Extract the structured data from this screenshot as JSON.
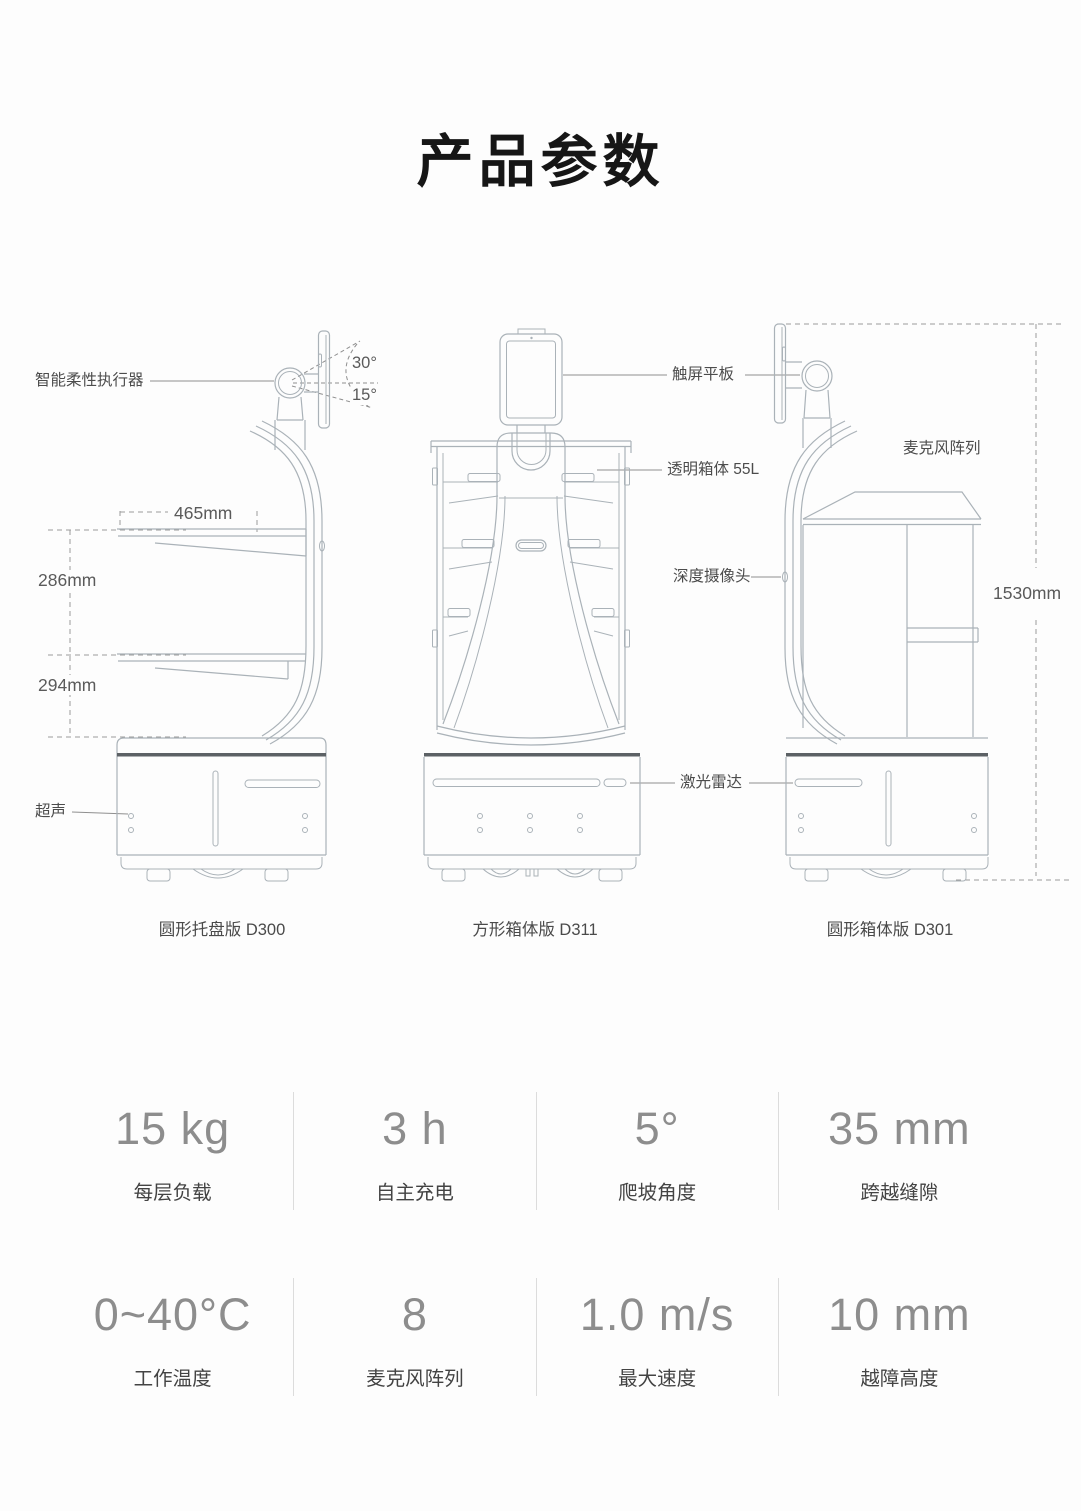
{
  "title": "产品参数",
  "colors": {
    "line_art": "#aab2b8",
    "dark_accent": "#5c6165",
    "dashed_dim": "#9a9a9a",
    "value_text": "#8d8d8d",
    "label_text": "#434343"
  },
  "diagram": {
    "models": [
      {
        "caption": "圆形托盘版 D300"
      },
      {
        "caption": "方形箱体版 D311"
      },
      {
        "caption": "圆形箱体版 D301"
      }
    ],
    "annotations": {
      "actuator": "智能柔性执行器",
      "tilt_up": "30°",
      "tilt_down": "15°",
      "tray_width": "465mm",
      "tray_gap_upper": "286mm",
      "tray_gap_lower": "294mm",
      "ultrasonic": "超声",
      "touchscreen": "触屏平板",
      "transparent_box": "透明箱体 55L",
      "depth_camera": "深度摄像头",
      "lidar": "激光雷达",
      "mic_array": "麦克风阵列",
      "total_height": "1530mm"
    }
  },
  "specs": {
    "rows": [
      [
        {
          "value": "15 kg",
          "label": "每层负载"
        },
        {
          "value": "3 h",
          "label": "自主充电"
        },
        {
          "value": "5°",
          "label": "爬坡角度"
        },
        {
          "value": "35 mm",
          "label": "跨越缝隙"
        }
      ],
      [
        {
          "value": "0~40°C",
          "label": "工作温度"
        },
        {
          "value": "8",
          "label": "麦克风阵列"
        },
        {
          "value": "1.0 m/s",
          "label": "最大速度"
        },
        {
          "value": "10 mm",
          "label": "越障高度"
        }
      ]
    ]
  }
}
